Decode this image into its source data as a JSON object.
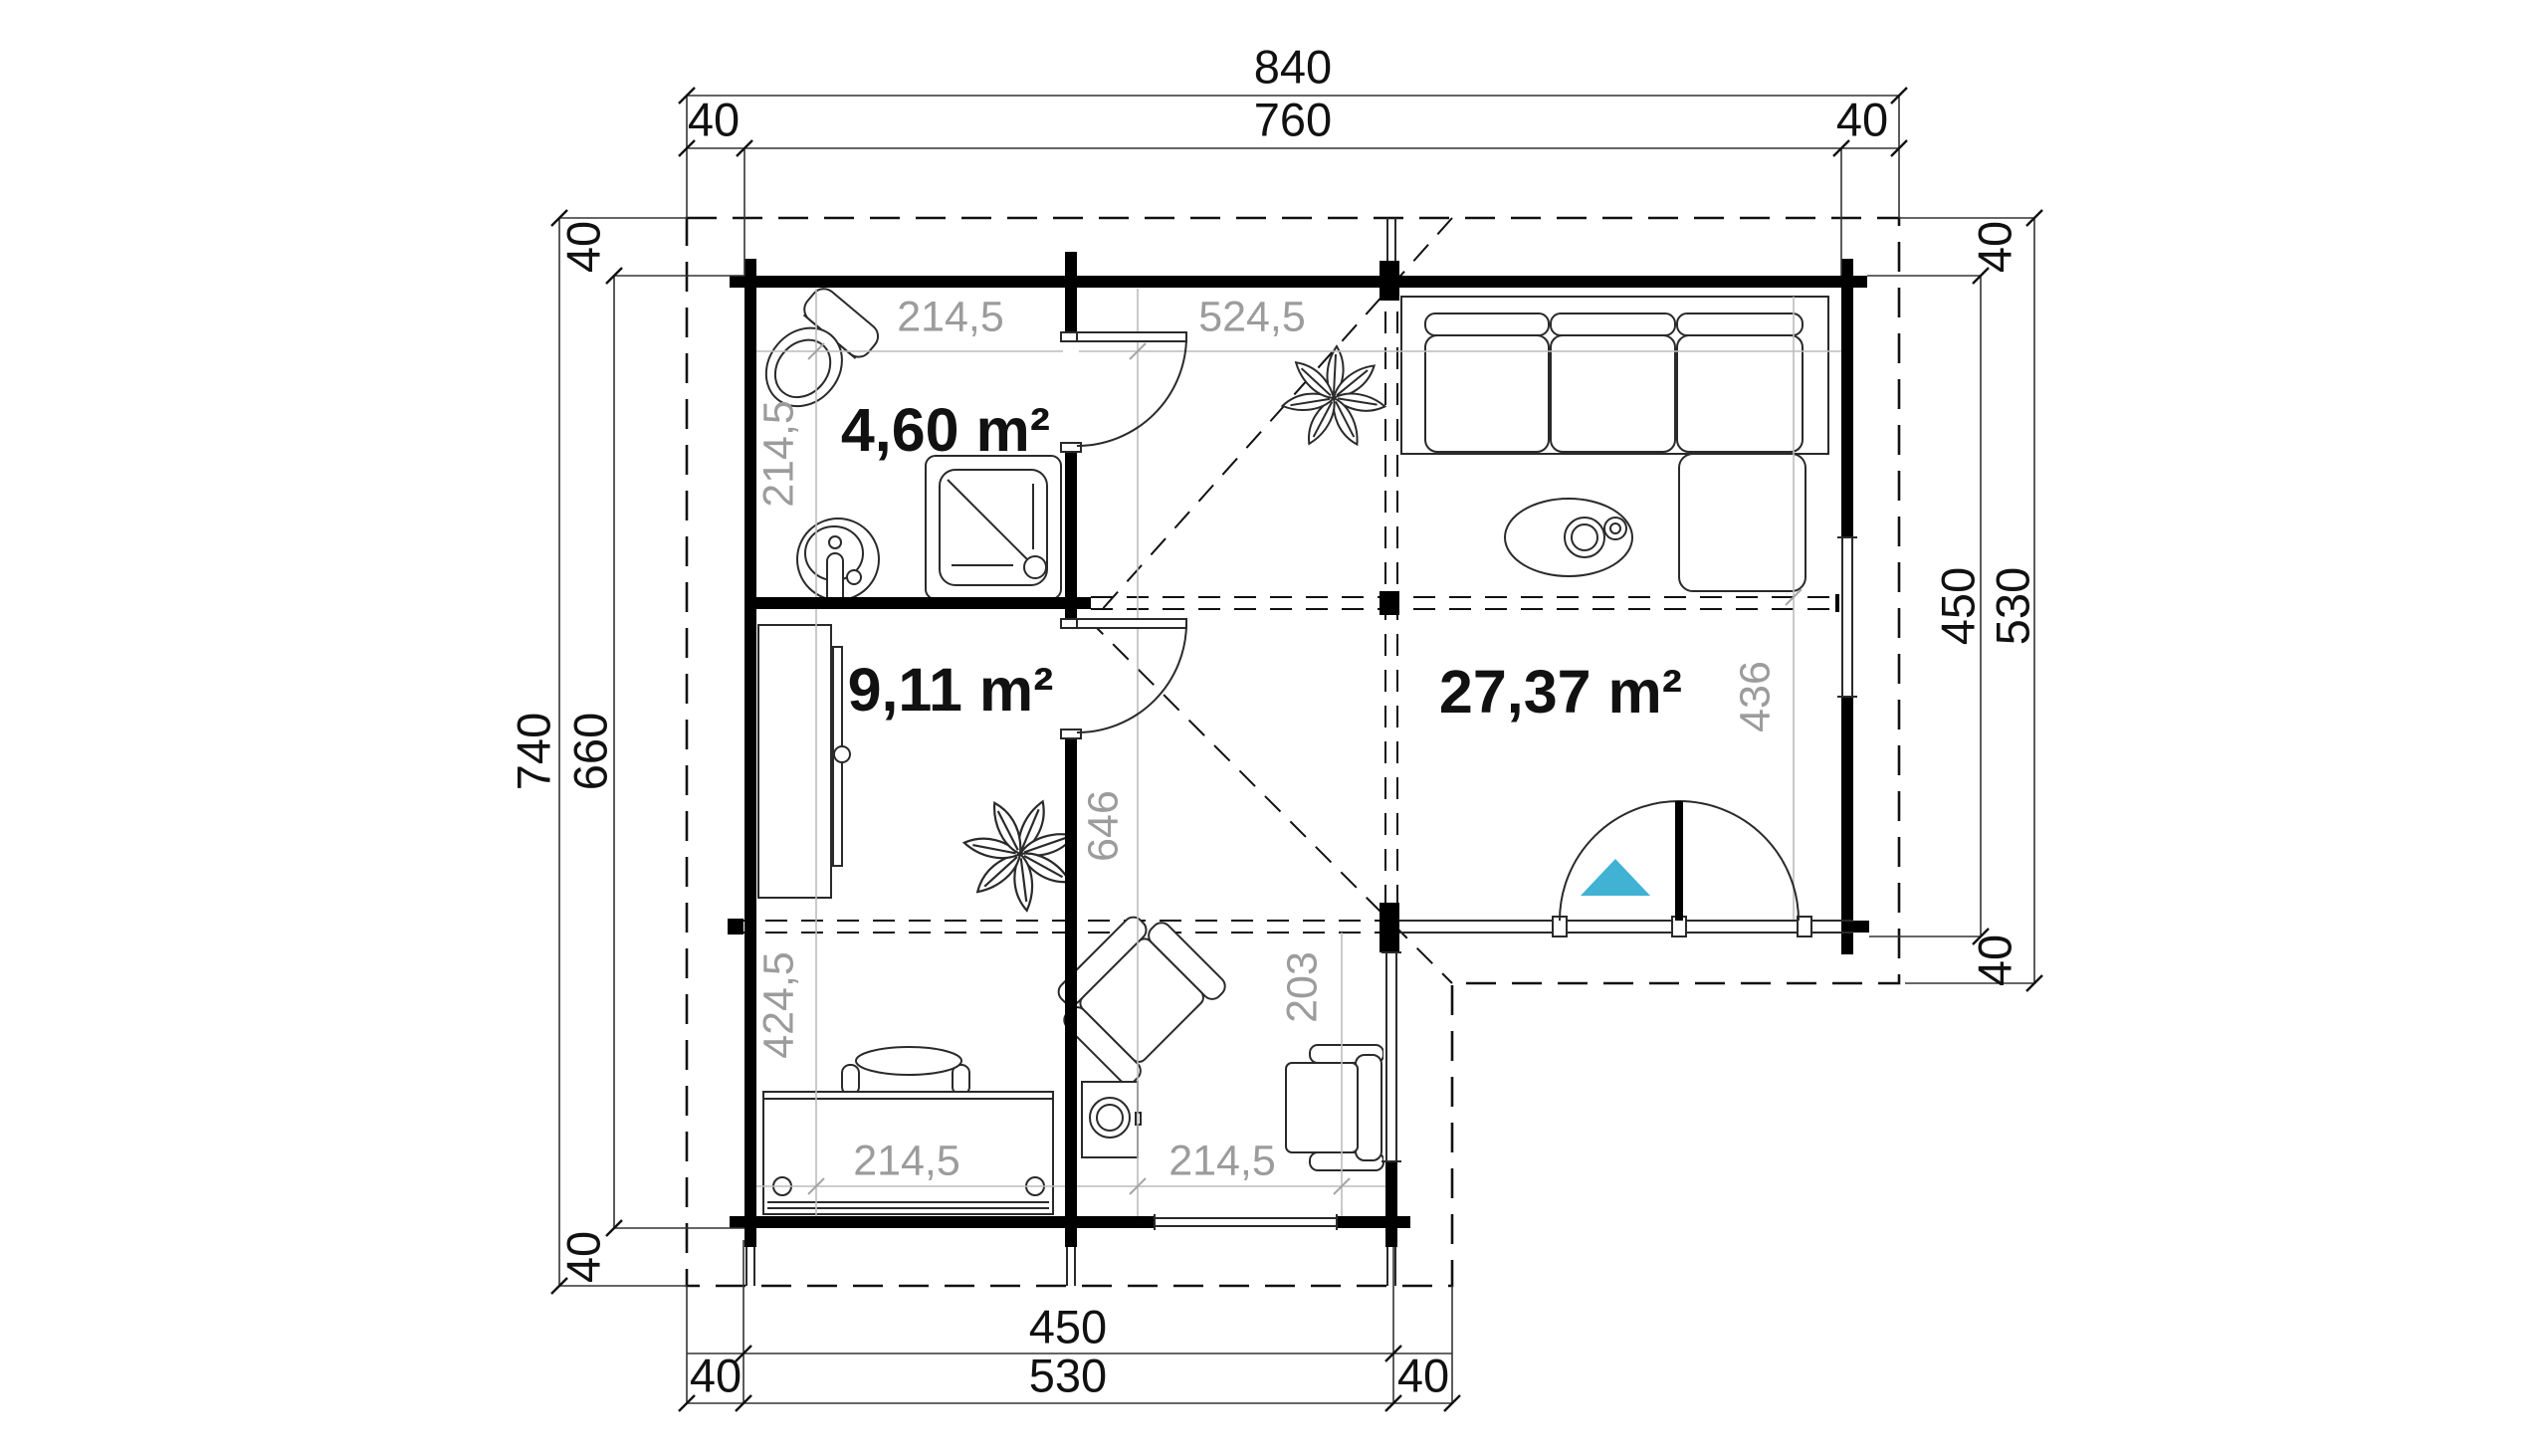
{
  "drawing": {
    "kind": "log-cabin floor plan",
    "accent_color": "#41b1d4",
    "wall_color": "#000000",
    "gray_label_color": "#9c9c9c"
  },
  "rooms": {
    "bathroom": {
      "area": "4,60 m²"
    },
    "bedroom": {
      "area": "9,11 m²"
    },
    "living": {
      "area": "27,37 m²"
    }
  },
  "dims": {
    "top": {
      "total": "840",
      "left_overhang": "40",
      "inner": "760",
      "right_overhang": "40"
    },
    "left": {
      "total": "740",
      "inner": "660",
      "top_overhang": "40",
      "bottom_overhang": "40"
    },
    "right": {
      "inner": "450",
      "total": "530",
      "top_overhang": "40",
      "bottom_overhang": "40"
    },
    "bottom": {
      "inner": "450",
      "total": "530",
      "left_overhang": "40",
      "right_overhang": "40"
    },
    "interior": {
      "bath_width": "214,5",
      "bath_depth": "214,5",
      "hall_living_width": "524,5",
      "bedroom_depth": "424,5",
      "hall_depth": "646",
      "porch_depth": "203",
      "living_width": "436",
      "desk_width": "214,5",
      "hall_width": "214,5"
    }
  }
}
